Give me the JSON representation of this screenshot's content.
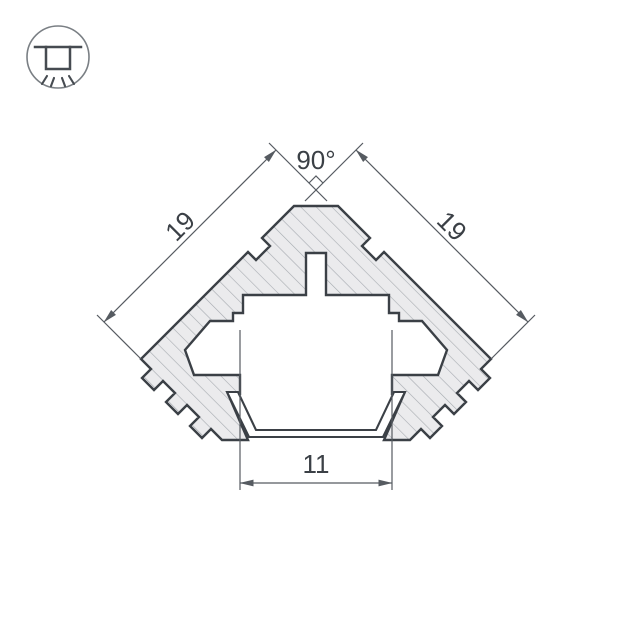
{
  "drawing": {
    "type": "technical-cross-section",
    "subject": "corner aluminium LED profile with diffuser",
    "dimensions": {
      "angle_top": "90°",
      "side_left": "19",
      "side_right": "19",
      "bottom_width": "11"
    },
    "icon": {
      "name": "recessed-ceiling-light-icon"
    },
    "colors": {
      "background": "#ffffff",
      "outline": "#3b4046",
      "hatch_fill": "#ebebed",
      "hatch_line": "#a6aab0",
      "dimension_line": "#565b61"
    }
  }
}
